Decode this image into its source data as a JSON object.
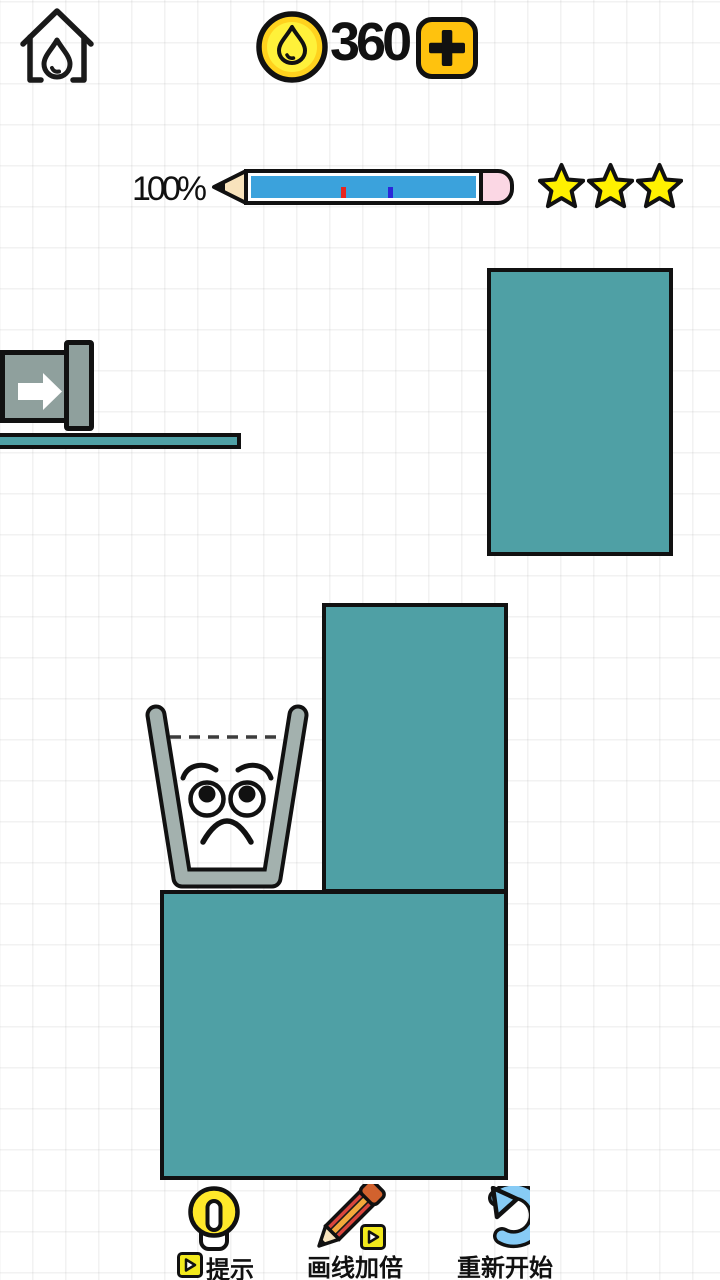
{
  "header": {
    "coin_balance": "360"
  },
  "progress": {
    "percent_label": "100%",
    "percent_value": 100,
    "stars": 3,
    "markers": [
      {
        "color": "#e8251f",
        "pos": 40
      },
      {
        "color": "#2a28d9",
        "pos": 61
      }
    ]
  },
  "footer": {
    "hint_label": "提示",
    "double_line_label": "画线加倍",
    "restart_label": "重新开始"
  },
  "icons": {
    "home": "home-icon (house with water drop)",
    "coin": "coin-icon (gold coin with water drop)",
    "add": "plus-icon",
    "progress": "pencil-progress-bar",
    "star": "star-icon",
    "spout": "arrow-spout-icon",
    "glass": "sad-glass-face",
    "hint": "lightbulb-icon",
    "double_line": "pencil-icon",
    "restart": "refresh-arrow-icon",
    "ad": "ad-play-icon"
  },
  "colors": {
    "teal": "#4fa0a5",
    "glass-gray": "#a3b1ae",
    "faucet-gray": "#8fa09d",
    "bar-blue": "#3ba2dc",
    "eraser-pink": "#fbd7e4",
    "wood-tan": "#f8e3bc",
    "coin-gold": "#ffd21e",
    "coin-inner": "#fff13a",
    "plus-gold": "#ffc20e",
    "star-yellow": "#fff100",
    "bulb-yellow": "#ffe82a",
    "restart-blue": "#87cbf5",
    "ad-yellow": "#f2e91c",
    "pencil-red": "#d9453c",
    "pencil-stripe": "#f2a93b",
    "pencil-cap": "#d2622e"
  }
}
